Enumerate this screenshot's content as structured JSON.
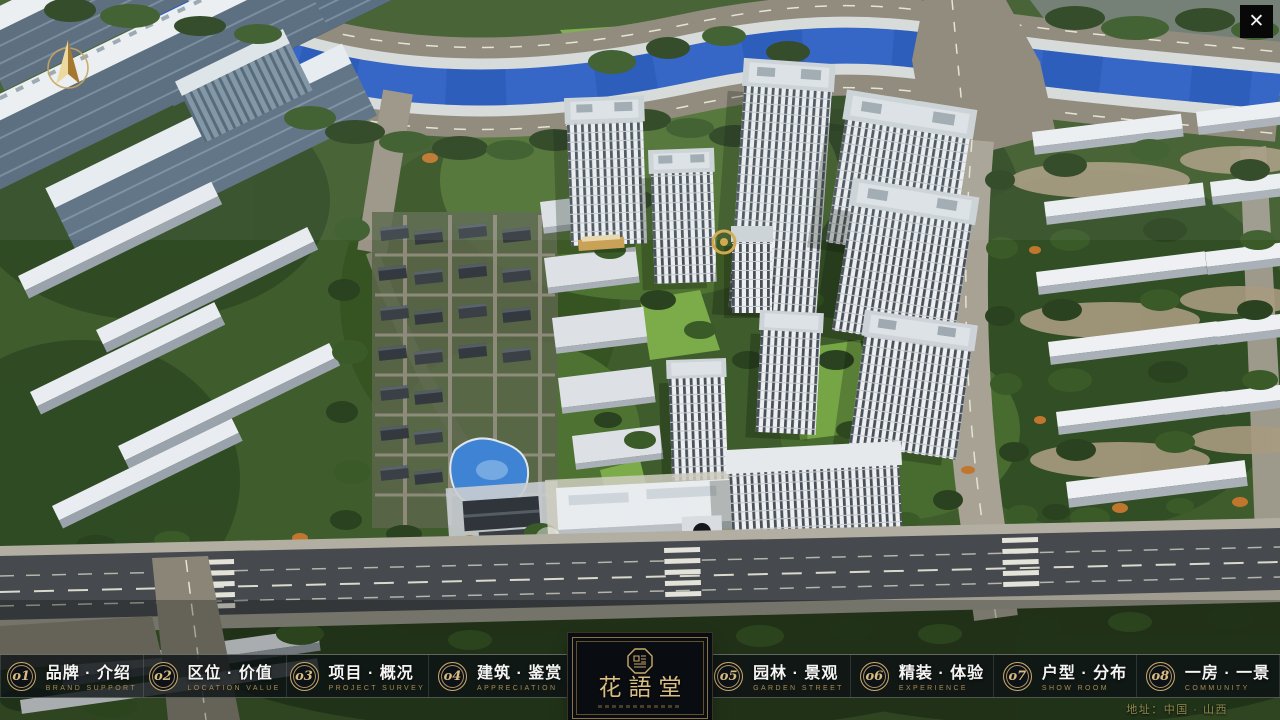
{
  "window": {
    "title": "花語堂 楼盘展示系统"
  },
  "icons": {
    "close_glyph": "✕",
    "compass": "north-arrow-icon",
    "seal": "octagonal-seal-icon"
  },
  "nav": {
    "items": [
      {
        "num": "o1",
        "zh": "品牌 · 介绍",
        "en": "BRAND SUPPORT"
      },
      {
        "num": "o2",
        "zh": "区位 · 价值",
        "en": "LOCATION VALUE"
      },
      {
        "num": "o3",
        "zh": "项目 · 概况",
        "en": "PROJECT SURVEY"
      },
      {
        "num": "o4",
        "zh": "建筑 · 鉴赏",
        "en": "APPRECIATION"
      },
      {
        "num": "o5",
        "zh": "园林 · 景观",
        "en": "GARDEN STREET"
      },
      {
        "num": "o6",
        "zh": "精装 · 体验",
        "en": "EXPERIENCE"
      },
      {
        "num": "o7",
        "zh": "户型 · 分布",
        "en": "SHOW ROOM"
      },
      {
        "num": "o8",
        "zh": "一房 · 一景",
        "en": "COMMUNITY"
      }
    ]
  },
  "logo": {
    "title": "花語堂"
  },
  "footer": {
    "address": "地址：中国 · 山西"
  },
  "palette": {
    "accent_gold": "#c9a96a",
    "bar_background": "rgba(13,17,21,0.80)",
    "river_blue": "#2a5ec4",
    "vegetation_green": "#3f5c2c",
    "main_road_gray": "#46494d",
    "roof_white": "#eef0f4",
    "address_gold": "#8f8a50"
  }
}
